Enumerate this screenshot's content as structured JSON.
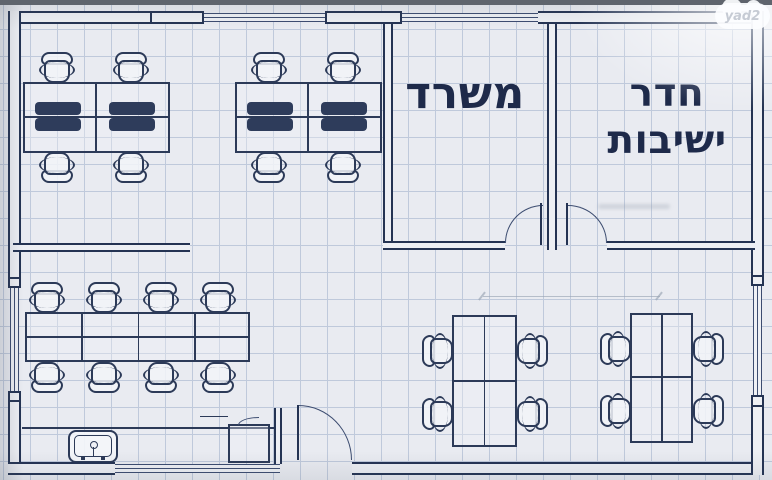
{
  "watermark": {
    "text": "yad2"
  },
  "rooms": {
    "office": {
      "label": "משרד"
    },
    "meeting": {
      "label": "חדר ישיבות",
      "line1": "חדר",
      "line2": "ישיבות"
    }
  },
  "plan_summary": {
    "type": "office floor plan (blueprint on grid paper)",
    "labeled_rooms": [
      "משרד",
      "חדר ישיבות"
    ],
    "furniture": {
      "desk_clusters": 2,
      "desks_per_cluster": 4,
      "desk_cluster_chairs": 8,
      "conference_table_seats": 8,
      "small_tables": 2,
      "seats_per_small_table": 4,
      "fixtures": [
        "sink",
        "counter",
        "cabinet"
      ]
    },
    "doors": 3,
    "windows": [
      "top wall x2",
      "left wall",
      "right wall",
      "bottom wall"
    ]
  },
  "colors": {
    "wall": "#243353",
    "window_line": "#3c4c70",
    "furniture_line": "#2c3a58",
    "monitor": "#2e3c5b",
    "text": "#1e2a4a",
    "background": "#e9ebf1",
    "grid": "#bfc9db",
    "pencil": "#9aa4b4",
    "logo_text": "#c6cbd4"
  }
}
